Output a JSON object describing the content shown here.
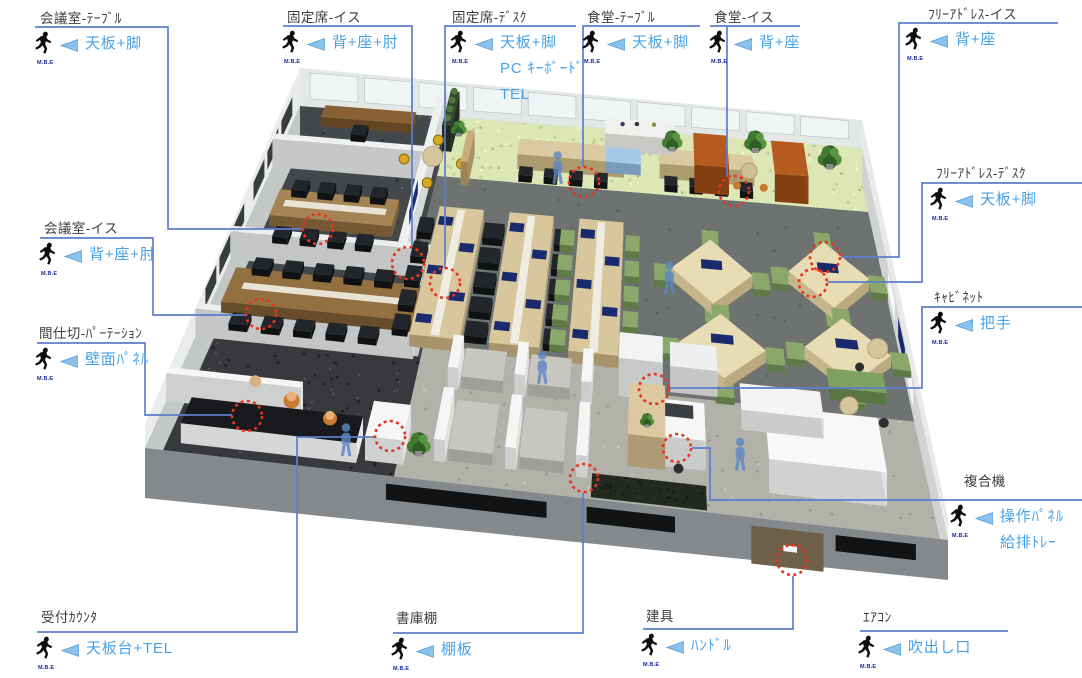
{
  "colors": {
    "leader_line": "#5b7ecd",
    "component_text": "#47a2e8",
    "title_text": "#3d3d3d",
    "marker": "#e8341f",
    "mbe_text": "#17279b",
    "chevron_fill": "#8ac2ec",
    "chevron_edge": "#549ad2",
    "figure": "#0c0d0e"
  },
  "icon": {
    "label": "M.B.E"
  },
  "annotations": [
    {
      "id": "meeting-room-table",
      "title": "会議室-ﾃｰﾌﾞﾙ",
      "components": [
        "天板+脚"
      ],
      "title_pos": [
        40,
        7
      ],
      "body_pos": [
        33,
        31
      ],
      "leaders": [
        [
          [
            35,
            27
          ],
          [
            168,
            27
          ],
          [
            168,
            229
          ],
          [
            303,
            229
          ]
        ]
      ],
      "marker": [
        318,
        229,
        15
      ]
    },
    {
      "id": "fixed-seat-chair",
      "title": "固定席-イス",
      "components": [
        "背+座+肘"
      ],
      "title_pos": [
        287,
        6
      ],
      "body_pos": [
        280,
        30
      ],
      "leaders": [
        [
          [
            283,
            26
          ],
          [
            412,
            26
          ],
          [
            412,
            247
          ]
        ]
      ],
      "marker": [
        408,
        263,
        16
      ]
    },
    {
      "id": "fixed-seat-desk",
      "title": "固定席-ﾃﾞｽｸ",
      "components": [
        "天板+脚",
        "PC ｷｰﾎﾞｰﾄﾞ",
        "TEL"
      ],
      "title_pos": [
        452,
        6
      ],
      "body_pos": [
        448,
        30
      ],
      "leaders": [
        [
          [
            576,
            26
          ],
          [
            445,
            26
          ],
          [
            445,
            268
          ]
        ]
      ],
      "marker": [
        445,
        283,
        15
      ]
    },
    {
      "id": "cafeteria-table",
      "title": "食堂-ﾃｰﾌﾞﾙ",
      "components": [
        "天板+脚"
      ],
      "title_pos": [
        587,
        6
      ],
      "body_pos": [
        580,
        30
      ],
      "leaders": [
        [
          [
            700,
            26
          ],
          [
            583,
            26
          ],
          [
            583,
            167
          ]
        ]
      ],
      "marker": [
        584,
        182,
        15
      ]
    },
    {
      "id": "cafeteria-chair",
      "title": "食堂-イス",
      "components": [
        "背+座"
      ],
      "title_pos": [
        714,
        6
      ],
      "body_pos": [
        707,
        30
      ],
      "leaders": [
        [
          [
            710,
            26
          ],
          [
            800,
            26
          ]
        ],
        [
          [
            727,
            26
          ],
          [
            727,
            177
          ]
        ]
      ],
      "marker": [
        734,
        191,
        15
      ]
    },
    {
      "id": "free-address-chair",
      "title": "ﾌﾘｰｱﾄﾞﾚｽ-イス",
      "components": [
        "背+座"
      ],
      "title_pos": [
        928,
        3
      ],
      "body_pos": [
        903,
        27
      ],
      "leaders": [
        [
          [
            1058,
            23
          ],
          [
            899,
            23
          ],
          [
            899,
            257
          ],
          [
            841,
            257
          ]
        ]
      ],
      "marker": [
        825,
        257,
        15
      ]
    },
    {
      "id": "free-address-desk",
      "title": "ﾌﾘｰｱﾄﾞﾚｽ-ﾃﾞｽｸ",
      "components": [
        "天板+脚"
      ],
      "title_pos": [
        936,
        162
      ],
      "body_pos": [
        928,
        187
      ],
      "leaders": [
        [
          [
            1082,
            183
          ],
          [
            922,
            183
          ],
          [
            922,
            282
          ],
          [
            828,
            282
          ]
        ]
      ],
      "marker": [
        813,
        283,
        14
      ]
    },
    {
      "id": "cabinet",
      "title": "ｷｬﾋﾞﾈｯﾄ",
      "components": [
        "把手"
      ],
      "title_pos": [
        934,
        286
      ],
      "body_pos": [
        928,
        311
      ],
      "leaders": [
        [
          [
            1082,
            307
          ],
          [
            922,
            307
          ],
          [
            922,
            388
          ],
          [
            670,
            388
          ]
        ]
      ],
      "marker": [
        654,
        389,
        15
      ]
    },
    {
      "id": "multifunction-printer",
      "title": "複合機",
      "components": [
        "操作ﾊﾟﾈﾙ",
        "給排ﾄﾚｰ"
      ],
      "title_pos": [
        964,
        470
      ],
      "body_pos": [
        948,
        504
      ],
      "leaders": [
        [
          [
            1082,
            500
          ],
          [
            710,
            500
          ],
          [
            710,
            448
          ],
          [
            692,
            448
          ]
        ]
      ],
      "marker": [
        677,
        448,
        14
      ]
    },
    {
      "id": "meeting-room-chair",
      "title": "会議室-イス",
      "components": [
        "背+座+肘"
      ],
      "title_pos": [
        44,
        217
      ],
      "body_pos": [
        37,
        242
      ],
      "leaders": [
        [
          [
            40,
            238
          ],
          [
            153,
            238
          ],
          [
            153,
            315
          ],
          [
            246,
            315
          ]
        ]
      ],
      "marker": [
        261,
        314,
        15
      ]
    },
    {
      "id": "partition",
      "title": "間仕切-ﾊﾟｰﾃｰｼｮﾝ",
      "components": [
        "壁面ﾊﾟﾈﾙ"
      ],
      "title_pos": [
        39,
        322
      ],
      "body_pos": [
        33,
        347
      ],
      "leaders": [
        [
          [
            37,
            343
          ],
          [
            145,
            343
          ],
          [
            145,
            415
          ],
          [
            232,
            415
          ]
        ]
      ],
      "marker": [
        247,
        416,
        15
      ]
    },
    {
      "id": "reception-counter",
      "title": "受付ｶｳﾝﾀ",
      "components": [
        "天板台+TEL"
      ],
      "title_pos": [
        41,
        606
      ],
      "body_pos": [
        34,
        636
      ],
      "leaders": [
        [
          [
            37,
            632
          ],
          [
            297,
            632
          ],
          [
            297,
            437
          ],
          [
            375,
            437
          ]
        ]
      ],
      "marker": [
        390,
        436,
        15
      ]
    },
    {
      "id": "book-shelf",
      "title": "書庫棚",
      "components": [
        "棚板"
      ],
      "title_pos": [
        396,
        607
      ],
      "body_pos": [
        389,
        637
      ],
      "leaders": [
        [
          [
            393,
            633
          ],
          [
            583,
            633
          ],
          [
            583,
            493
          ]
        ]
      ],
      "marker": [
        584,
        478,
        14
      ]
    },
    {
      "id": "fittings-door",
      "title": "建具",
      "components": [
        "ﾊﾝﾄﾞﾙ"
      ],
      "title_pos": [
        646,
        605
      ],
      "body_pos": [
        639,
        633
      ],
      "leaders": [
        [
          [
            643,
            629
          ],
          [
            793,
            629
          ],
          [
            793,
            576
          ]
        ]
      ],
      "marker": [
        792,
        560,
        15
      ]
    },
    {
      "id": "air-conditioner",
      "title": "ｴｱｺﾝ",
      "components": [
        "吹出し口"
      ],
      "title_pos": [
        863,
        606
      ],
      "body_pos": [
        856,
        635
      ],
      "leaders": [
        [
          [
            860,
            631
          ],
          [
            1008,
            631
          ]
        ]
      ],
      "marker": null
    }
  ]
}
